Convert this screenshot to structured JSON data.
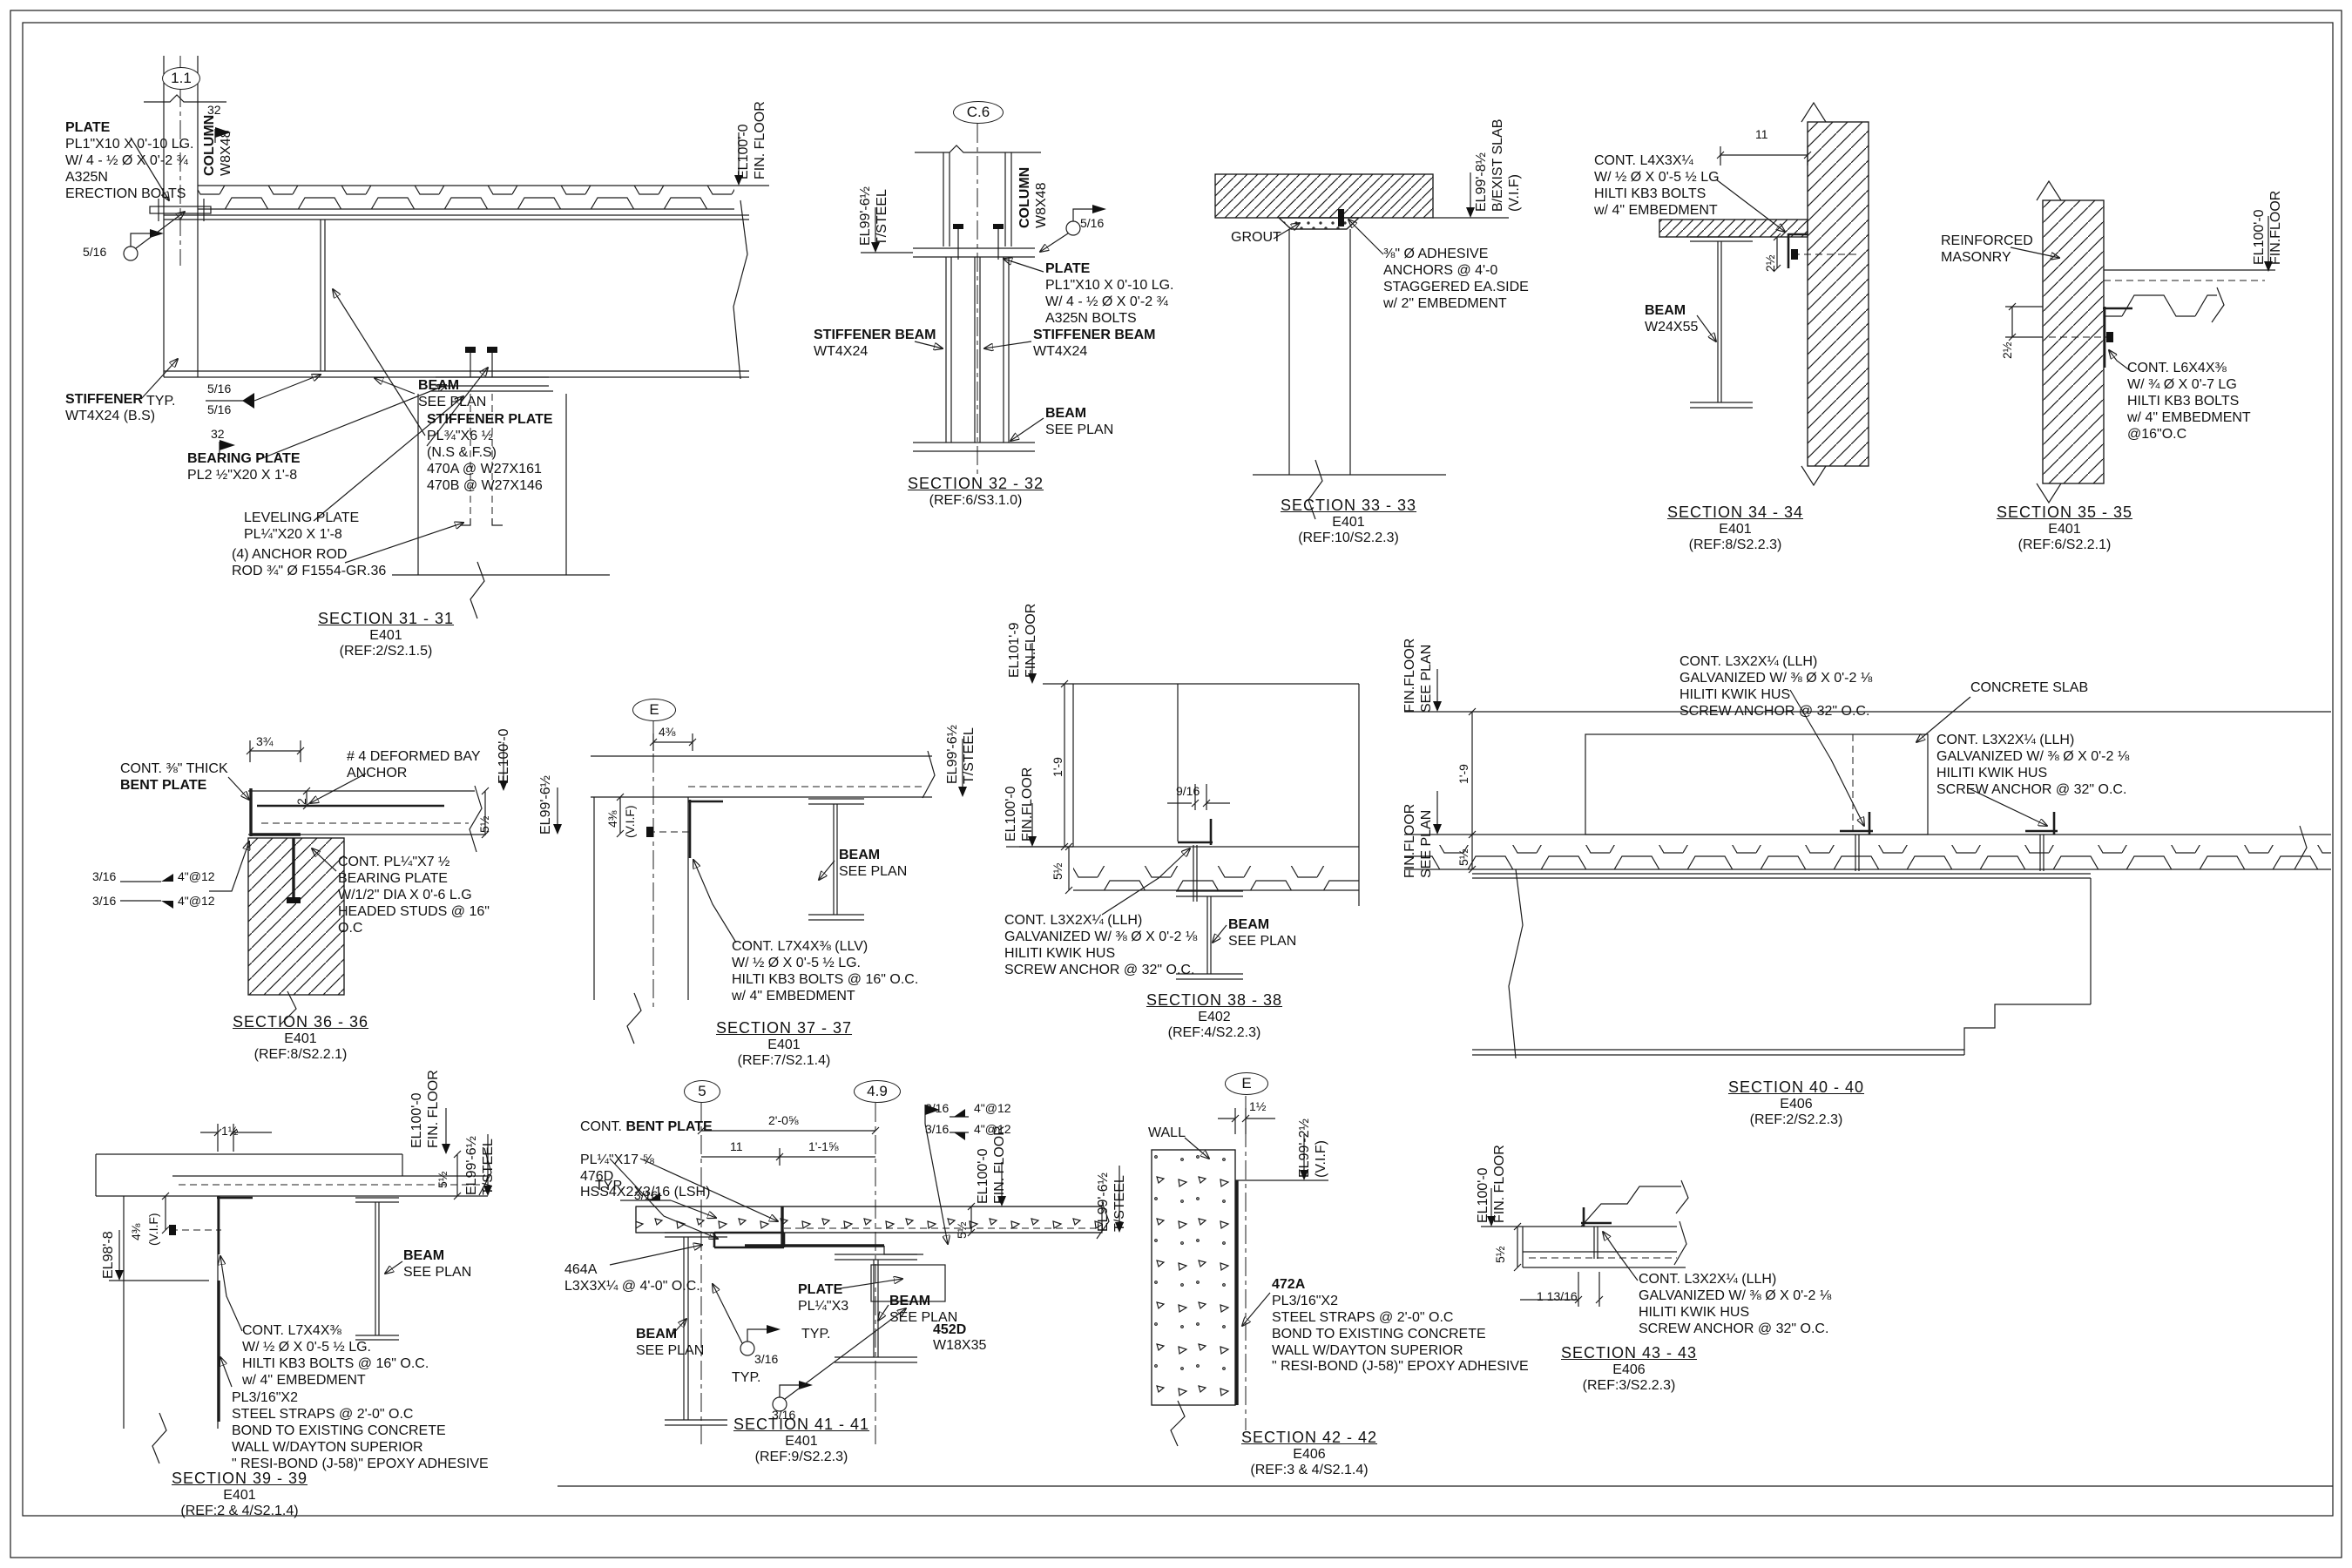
{
  "sections": {
    "s31": {
      "bubble": "1.1",
      "labels": {
        "plate_h": "PLATE",
        "plate_b": "PL1\"X10 X 0'-10 LG.\nW/ 4 - ½ Ø X 0'-2 ¾\nA325N\nERECTION BOLTS",
        "col_h": "COLUMN",
        "col_b": "W8X48",
        "dim32a": "32",
        "dim32b": "32",
        "w516a": "5/16",
        "typ": "TYP.",
        "w516b": "5/16",
        "w516c": "5/16",
        "stif_h": "STIFFENER",
        "stif_b": "WT4X24 (B.S)",
        "bear_h": "BEARING PLATE",
        "bear_b": "PL2 ½\"X20 X 1'-8",
        "lev": "LEVELING PLATE\nPL¼\"X20 X 1'-8",
        "rod": "(4) ANCHOR ROD\nROD ¾\" Ø F1554-GR.36",
        "sp_h": "STIFFENER PLATE",
        "sp_b": "PL¾\"X6 ½\n(N.S & F.S)\n470A @ W27X161\n470B @ W27X146",
        "beam_h": "BEAM",
        "beam_b": "SEE PLAN",
        "el": "EL100'-0\nFIN. FLOOR"
      },
      "title": "SECTION 31 - 31",
      "sheetno": "E401",
      "ref": "(REF:2/S2.1.5)"
    },
    "s32": {
      "bubble": "C.6",
      "labels": {
        "el": "EL99'-6½\nT/STEEL",
        "col_h": "COLUMN",
        "col_b": "W8X48",
        "w516": "5/16",
        "plate_h": "PLATE",
        "plate_b": "PL1\"X10 X 0'-10 LG.\nW/ 4 - ½ Ø X 0'-2 ¾\nA325N BOLTS",
        "sbL_h": "STIFFENER BEAM",
        "sbL_b": "WT4X24",
        "sbR_h": "STIFFENER BEAM",
        "sbR_b": "WT4X24",
        "beam_h": "BEAM",
        "beam_b": "SEE PLAN"
      },
      "title": "SECTION 32 - 32",
      "ref": "(REF:6/S3.1.0)"
    },
    "s33": {
      "labels": {
        "el": "EL99'-8½\nB/EXIST SLAB\n(V.I.F)",
        "grout": "GROUT",
        "anchors": "⅜\" Ø ADHESIVE\nANCHORS @ 4'-0\nSTAGGERED EA.SIDE\nw/ 2\" EMBEDMENT"
      },
      "title": "SECTION 33 - 33",
      "sheetno": "E401",
      "ref": "(REF:10/S2.2.3)"
    },
    "s34": {
      "labels": {
        "dim11": "11",
        "angle": "CONT. L4X3X¼\nW/ ½ Ø X 0'-5 ½ LG\nHILTI KB3 BOLTS\nw/ 4\" EMBEDMENT",
        "dim2h": "2½",
        "beam_h": "BEAM",
        "beam_b": "W24X55"
      },
      "title": "SECTION 34 - 34",
      "sheetno": "E401",
      "ref": "(REF:8/S2.2.3)"
    },
    "s35": {
      "labels": {
        "masonry": "REINFORCED\nMASONRY",
        "el": "EL100'-0\nFIN.FLOOR",
        "dim2h": "2½",
        "angle": "CONT. L6X4X⅜\nW/ ¾ Ø X 0'-7 LG\nHILTI KB3 BOLTS\nw/ 4\" EMBEDMENT\n@16\"O.C"
      },
      "title": "SECTION 35 - 35",
      "sheetno": "E401",
      "ref": "(REF:6/S2.2.1)"
    },
    "s36": {
      "labels": {
        "bent1": "CONT. ⅜\" THICK",
        "bent2": "BENT PLATE",
        "dim334": "3¾",
        "bay": "# 4 DEFORMED BAY\nANCHOR",
        "el100": "EL100'-0",
        "dim512": "5½",
        "el996": "EL99'-6½",
        "dim2": "2",
        "w316a": "3/16",
        "w316b": "3/16",
        "s412a": "4\"@12",
        "s412b": "4\"@12",
        "bearing": "CONT. PL¼\"X7 ½\nBEARING PLATE\nW/1/2\" DIA X 0'-6 L.G\nHEADED STUDS @ 16\"\nO.C"
      },
      "title": "SECTION 36 - 36",
      "sheetno": "E401",
      "ref": "(REF:8/S2.2.1)"
    },
    "s37": {
      "bubble": "E",
      "labels": {
        "dim438a": "4⅜",
        "dim438b": "4⅜",
        "vif": "(V.I.F)",
        "el": "EL99'-6½\nT/STEEL",
        "beam_h": "BEAM",
        "beam_b": "SEE PLAN",
        "angle": "CONT. L7X4X⅜ (LLV)\nW/ ½ Ø X 0'-5 ½ LG.\nHILTI KB3 BOLTS @ 16\" O.C.\nw/ 4\" EMBEDMENT"
      },
      "title": "SECTION 37 - 37",
      "sheetno": "E401",
      "ref": "(REF:7/S2.1.4)"
    },
    "s38": {
      "labels": {
        "el1019": "EL101'-9\nFIN.FLOOR",
        "dim19": "1'-9",
        "el1000": "EL100'-0\nFIN.FLOOR",
        "dim916": "9/16",
        "dim512": "5½",
        "angle": "CONT. L3X2X¼ (LLH)\nGALVANIZED W/ ⅜ Ø X 0'-2 ⅛\nHILITI KWIK HUS\nSCREW ANCHOR @ 32\" O.C.",
        "beam_h": "BEAM",
        "beam_b": "SEE PLAN"
      },
      "title": "SECTION 38 - 38",
      "sheetno": "E402",
      "ref": "(REF:4/S2.2.3)"
    },
    "s39": {
      "labels": {
        "dim112": "1½",
        "el100": "EL100'-0\nFIN. FLOOR",
        "el996": "EL99'-6½\nT/STEEL",
        "dim512": "5½",
        "dim438": "4⅜",
        "vif": "(V.I.F)",
        "el988": "EL98'-8",
        "beam_h": "BEAM",
        "beam_b": "SEE PLAN",
        "angle": "CONT. L7X4X⅜\nW/ ½ Ø X 0'-5 ½ LG.\nHILTI KB3 BOLTS @ 16\" O.C.\nw/ 4\" EMBEDMENT",
        "strap": "PL3/16\"X2\nSTEEL STRAPS @ 2'-0\" O.C\nBOND TO EXISTING CONCRETE\nWALL W/DAYTON SUPERIOR\n\" RESI-BOND (J-58)\" EPOXY ADHESIVE"
      },
      "title": "SECTION 39 - 39",
      "sheetno": "E401",
      "ref": "(REF:2 & 4/S2.1.4)"
    },
    "s40": {
      "labels": {
        "finA": "FIN.FLOOR\nSEE PLAN",
        "finB": "FIN.FLOOR\nSEE PLAN",
        "dim19": "1'-9",
        "dim512": "5½",
        "angleL": "CONT. L3X2X¼ (LLH)\nGALVANIZED W/ ⅜ Ø X 0'-2 ⅛\nHILITI KWIK HUS\nSCREW ANCHOR @ 32\" O.C.",
        "slab": "CONCRETE SLAB",
        "angleR": "CONT. L3X2X¼ (LLH)\nGALVANIZED W/ ⅜ Ø X 0'-2 ⅛\nHILITI KWIK HUS\nSCREW ANCHOR @ 32\" O.C."
      },
      "title": "SECTION 40 - 40",
      "sheetno": "E406",
      "ref": "(REF:2/S2.2.3)"
    },
    "s41": {
      "bubble5": "5",
      "bubble49": "4.9",
      "labels": {
        "bent_pre": "CONT. ",
        "bent_h": "BENT PLATE",
        "bent_b": "PL¼\"X17 ⅝\n476D\nHSS4X2X3/16 (LSH)",
        "w316a": "3/16",
        "w316b": "3/16",
        "s412a": "4\"@12",
        "s412b": "4\"@12",
        "dim208": "2'-0⅝",
        "dim11": "11",
        "dim1158": "1'-1⅝",
        "typ1": "TYP.",
        "w316c": "3/16",
        "el100": "EL100'-0\nFIN. FLOOR",
        "dim512": "5½",
        "el996": "EL99'-6½\nT/STEEL",
        "a464": "464A\nL3X3X¼ @ 4'-0\" O.C.",
        "plate_h": "PLATE",
        "plate_b": "PL¼\"X3",
        "beamR_h": "BEAM",
        "beamR_b": "SEE PLAN",
        "d452": "452D",
        "w1835": "W18X35",
        "beamL_h": "BEAM",
        "beamL_b": "SEE PLAN",
        "typ2": "TYP.",
        "w316d": "3/16",
        "typ3": "TYP.",
        "w316e": "3/16"
      },
      "title": "SECTION 41 - 41",
      "sheetno": "E401",
      "ref": "(REF:9/S2.2.3)"
    },
    "s42": {
      "bubble": "E",
      "labels": {
        "wall": "WALL",
        "dim112": "1½",
        "el": "EL99'-2½\n(V.I.F)",
        "s472_h": "472A",
        "s472_b": "PL3/16\"X2\nSTEEL STRAPS @ 2'-0\" O.C\nBOND TO EXISTING CONCRETE\nWALL W/DAYTON SUPERIOR\n\" RESI-BOND (J-58)\" EPOXY ADHESIVE"
      },
      "title": "SECTION 42 - 42",
      "sheetno": "E406",
      "ref": "(REF:3 & 4/S2.1.4)"
    },
    "s43": {
      "labels": {
        "el": "EL100'-0\nFIN. FLOOR",
        "dim512": "5½",
        "dim11316": "1 13/16",
        "angle": "CONT. L3X2X¼ (LLH)\nGALVANIZED W/ ⅜ Ø X 0'-2 ⅛\nHILITI KWIK HUS\nSCREW ANCHOR @ 32\" O.C."
      },
      "title": "SECTION 43 - 43",
      "sheetno": "E406",
      "ref": "(REF:3/S2.2.3)"
    }
  }
}
